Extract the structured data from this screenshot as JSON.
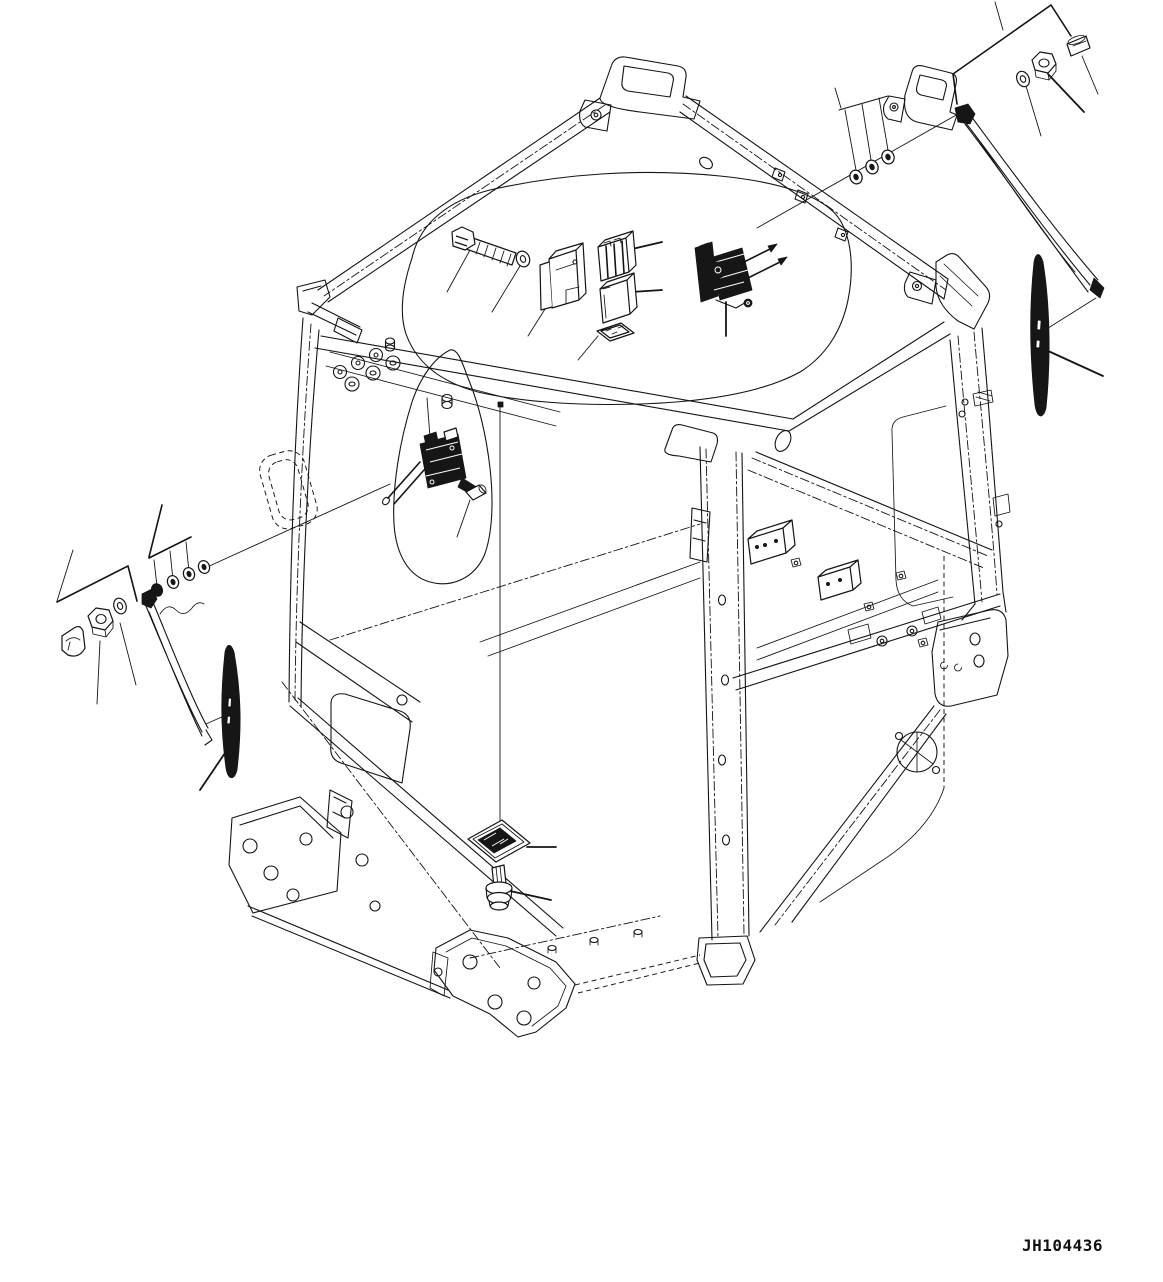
{
  "diagram": {
    "drawing_number": "JH104436",
    "style": {
      "background": "#ffffff",
      "line_color": "#141414"
    },
    "view": "isometric exploded parts view of operator cab frame with wiper components",
    "parts": [
      {
        "name": "cab-frame"
      },
      {
        "name": "roof-window-cutout"
      },
      {
        "name": "front-window-cutout"
      },
      {
        "name": "hex-bolt"
      },
      {
        "name": "flat-washer"
      },
      {
        "name": "relay-bracket-cover"
      },
      {
        "name": "relay-box-upper"
      },
      {
        "name": "relay-box-lower"
      },
      {
        "name": "wire-connector-plate"
      },
      {
        "name": "front-wiper-motor"
      },
      {
        "name": "lower-wiper-motor"
      },
      {
        "name": "wiper-pivot-cap"
      },
      {
        "name": "roof-mount-washers"
      },
      {
        "name": "right-mount-hardware-callout"
      },
      {
        "name": "right-cap-nut"
      },
      {
        "name": "right-hex-nut"
      },
      {
        "name": "right-washer"
      },
      {
        "name": "right-wiper-arm"
      },
      {
        "name": "right-wiper-blade"
      },
      {
        "name": "left-mount-hardware-callout"
      },
      {
        "name": "left-clamp-cap"
      },
      {
        "name": "left-hex-nut"
      },
      {
        "name": "left-washer"
      },
      {
        "name": "left-mount-washers"
      },
      {
        "name": "left-wiper-arm"
      },
      {
        "name": "left-wiper-blade"
      },
      {
        "name": "switch-plate"
      },
      {
        "name": "grommet-bolt"
      }
    ]
  }
}
